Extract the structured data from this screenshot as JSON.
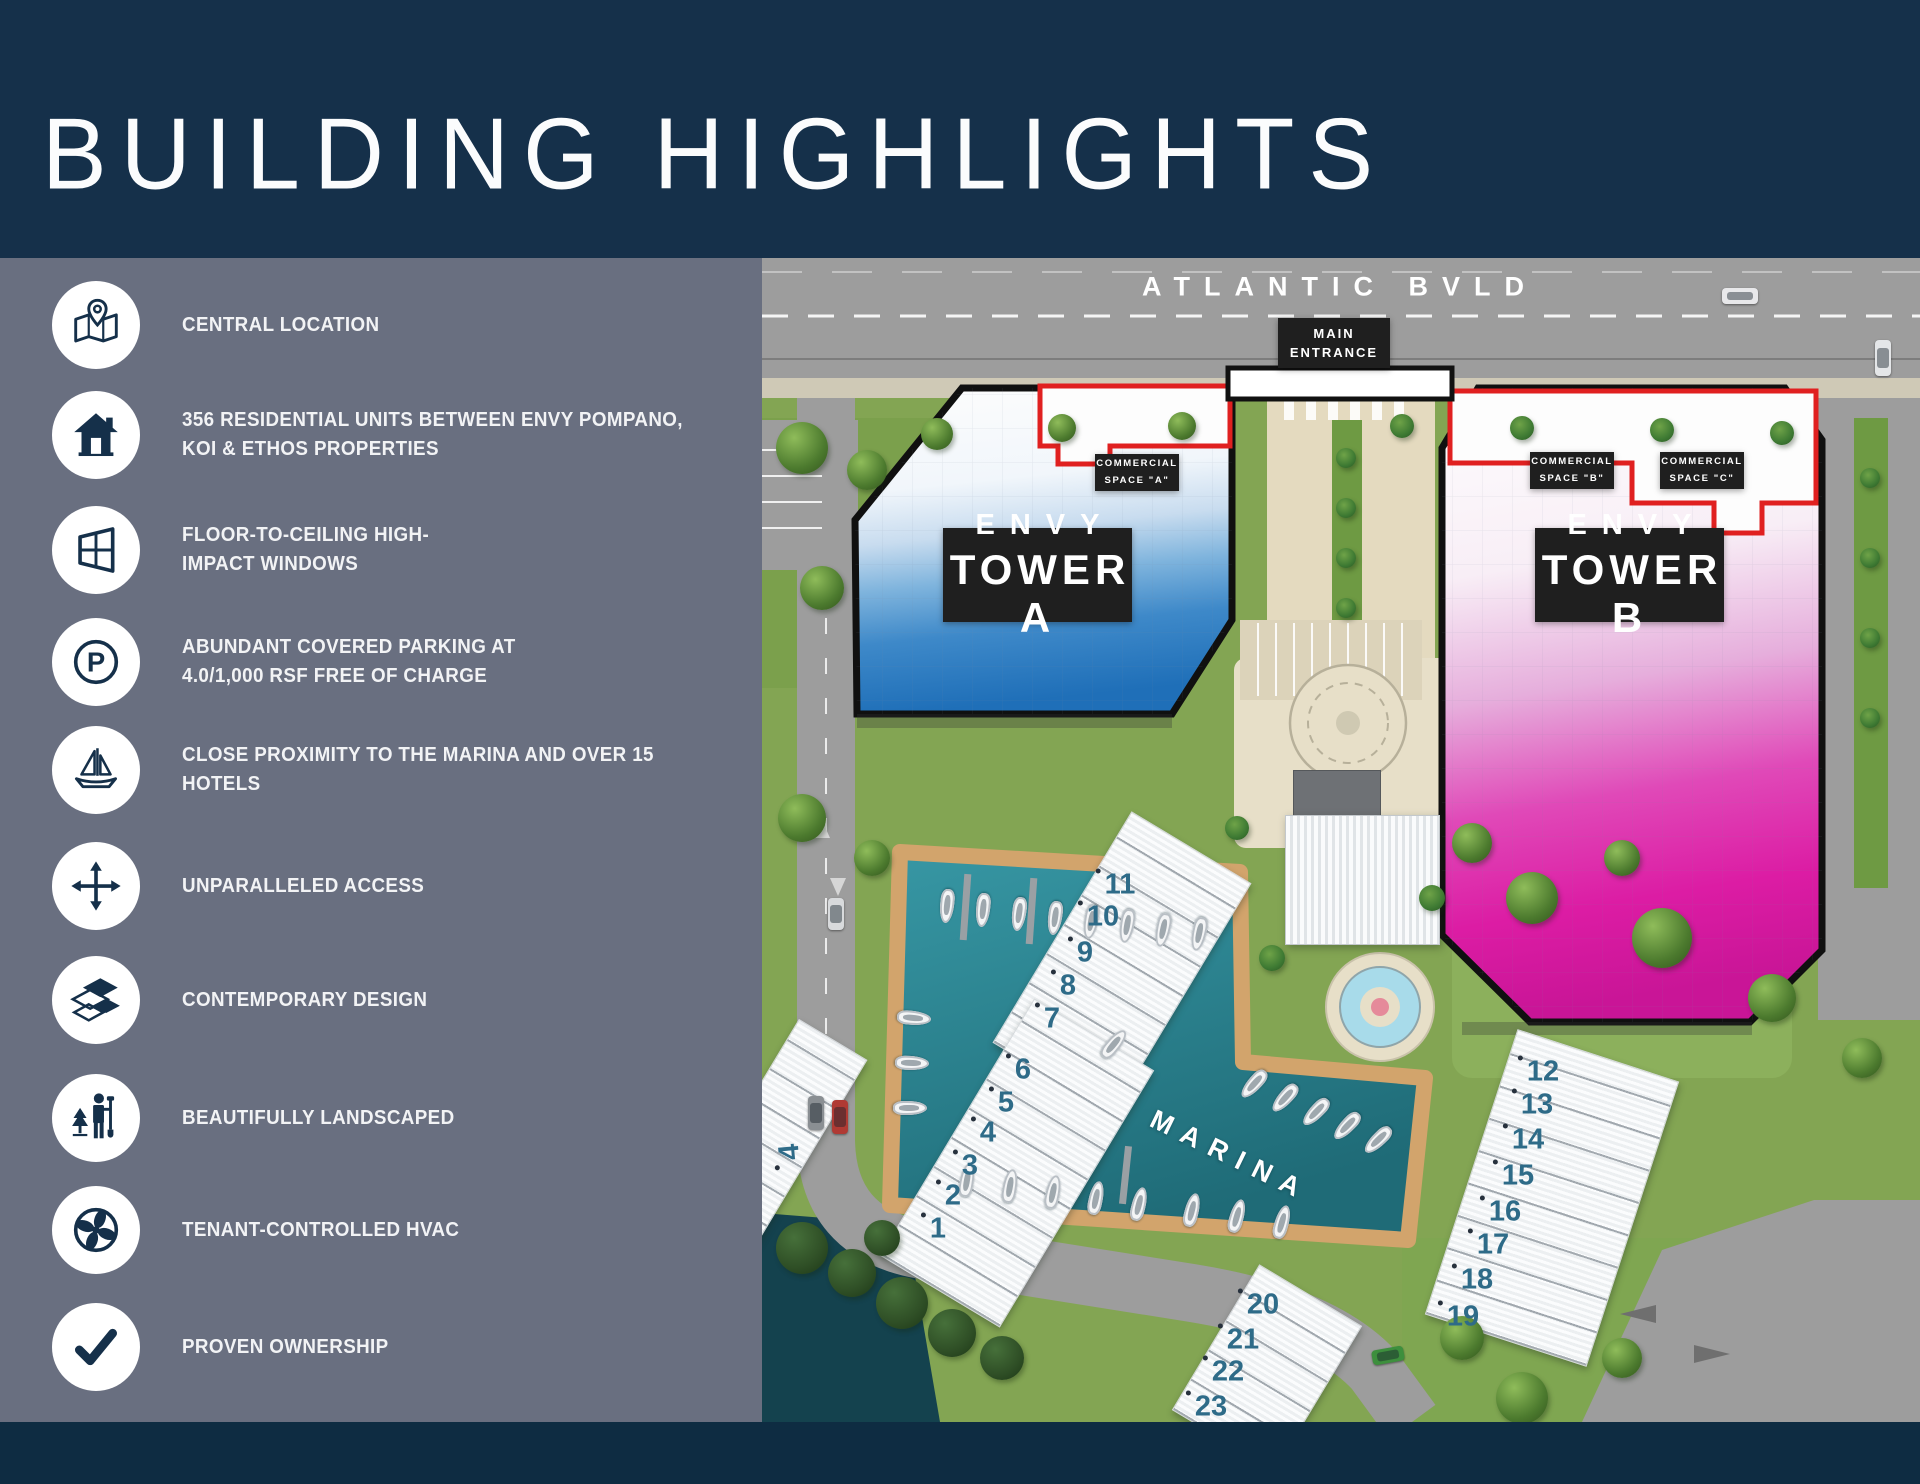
{
  "title": "BUILDING HIGHLIGHTS",
  "colors": {
    "header_navy": "#15304A",
    "sidebar_gray": "#696F80",
    "footer_navy": "#0E2C42",
    "accent_red": "#E02020",
    "tower_a_blue": "#2276BF",
    "tower_b_magenta": "#DC1CA4",
    "marina_teal": "#2F8E9B",
    "unit_number_blue": "#2E6B88",
    "label_black": "#1F1F1F"
  },
  "sidebar": {
    "items": [
      {
        "icon": "map-location-icon",
        "label": "CENTRAL LOCATION"
      },
      {
        "icon": "house-icon",
        "label": "356 RESIDENTIAL UNITS BETWEEN ENVY POMPANO,\nKOI & ETHOS PROPERTIES"
      },
      {
        "icon": "window-icon",
        "label": "FLOOR-TO-CEILING HIGH-\nIMPACT WINDOWS"
      },
      {
        "icon": "parking-icon",
        "label": "ABUNDANT COVERED PARKING AT\n4.0/1,000 RSF FREE OF CHARGE"
      },
      {
        "icon": "sailboat-icon",
        "label": "CLOSE PROXIMITY TO THE MARINA AND OVER 15\nHOTELS"
      },
      {
        "icon": "move-arrows-icon",
        "label": "UNPARALLELED ACCESS"
      },
      {
        "icon": "floor-tiles-icon",
        "label": "CONTEMPORARY DESIGN"
      },
      {
        "icon": "landscaping-icon",
        "label": "BEAUTIFULLY LANDSCAPED"
      },
      {
        "icon": "fan-icon",
        "label": "TENANT-CONTROLLED HVAC"
      },
      {
        "icon": "checkmark-icon",
        "label": "PROVEN OWNERSHIP"
      }
    ]
  },
  "icons": {
    "parking_glyph": "P"
  },
  "map": {
    "street_label": "ATLANTIC BVLD",
    "main_entrance_label": "MAIN\nENTRANCE",
    "commercial_spaces": [
      {
        "label": "COMMERCIAL\nSPACE \"A\""
      },
      {
        "label": "COMMERCIAL\nSPACE \"B\""
      },
      {
        "label": "COMMERCIAL\nSPACE \"C\""
      }
    ],
    "towers": [
      {
        "line1": "ENVY",
        "line2": "TOWER A"
      },
      {
        "line1": "ENVY",
        "line2": "TOWER B"
      }
    ],
    "marina_label": "MARINA",
    "unit_numbers": [
      {
        "n": "1",
        "x": 176,
        "y": 971
      },
      {
        "n": "2",
        "x": 191,
        "y": 938
      },
      {
        "n": "3",
        "x": 208,
        "y": 908
      },
      {
        "n": "4",
        "x": 226,
        "y": 875
      },
      {
        "n": "5",
        "x": 244,
        "y": 845
      },
      {
        "n": "6",
        "x": 261,
        "y": 812
      },
      {
        "n": "7",
        "x": 290,
        "y": 761
      },
      {
        "n": "8",
        "x": 306,
        "y": 728
      },
      {
        "n": "9",
        "x": 323,
        "y": 695
      },
      {
        "n": "10",
        "x": 341,
        "y": 659
      },
      {
        "n": "11",
        "x": 358,
        "y": 627
      },
      {
        "n": "12",
        "x": 781,
        "y": 814
      },
      {
        "n": "13",
        "x": 775,
        "y": 847
      },
      {
        "n": "14",
        "x": 766,
        "y": 882
      },
      {
        "n": "15",
        "x": 756,
        "y": 918
      },
      {
        "n": "16",
        "x": 743,
        "y": 954
      },
      {
        "n": "17",
        "x": 731,
        "y": 987
      },
      {
        "n": "18",
        "x": 715,
        "y": 1022
      },
      {
        "n": "19",
        "x": 701,
        "y": 1059
      },
      {
        "n": "20",
        "x": 501,
        "y": 1047
      },
      {
        "n": "21",
        "x": 481,
        "y": 1082
      },
      {
        "n": "22",
        "x": 466,
        "y": 1114
      },
      {
        "n": "23",
        "x": 449,
        "y": 1149
      },
      {
        "n": "4",
        "x": 28,
        "y": 894,
        "rot": -95
      }
    ]
  }
}
